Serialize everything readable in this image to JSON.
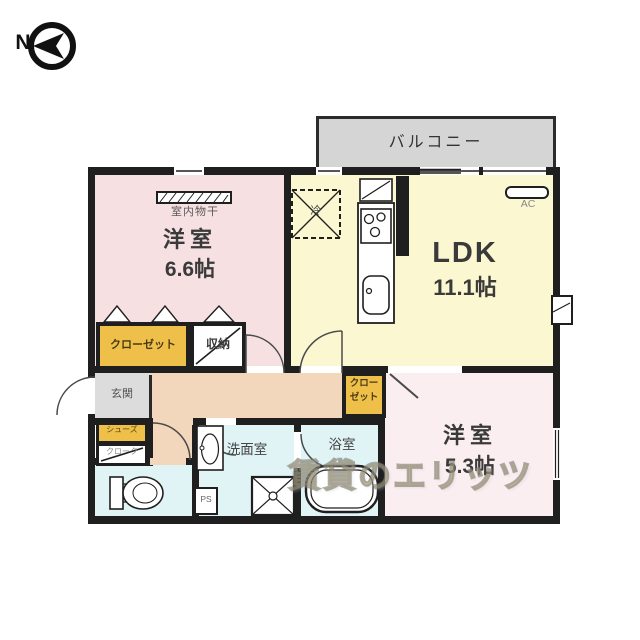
{
  "compass": {
    "north": "N"
  },
  "balcony": {
    "label": "バルコニー"
  },
  "bedroom1": {
    "name": "洋室",
    "size": "6.6帖",
    "drying": "室内物干"
  },
  "ldk": {
    "name": "LDK",
    "size": "11.1帖",
    "ac": "AC",
    "fridge": "冷"
  },
  "bedroom2": {
    "name": "洋室",
    "size": "5.3帖"
  },
  "closet1": {
    "label": "クローゼット"
  },
  "storage": {
    "label": "収納"
  },
  "closet2": {
    "line1": "クロー",
    "line2": "ゼット"
  },
  "entrance": {
    "label": "玄関"
  },
  "shoes_closet": {
    "line1": "シューズ",
    "line2": "クローク"
  },
  "washroom": {
    "label": "洗面室"
  },
  "bathroom": {
    "label": "浴室"
  },
  "pipe_space": {
    "label": "PS"
  },
  "watermark": {
    "text": "賃貸のエリッツ"
  },
  "colors": {
    "wall": "#1f1f1f",
    "bedroom1_fill": "#f7e0e1",
    "ldk_fill": "#fbf7d0",
    "bedroom2_fill": "#fbeef0",
    "hall_fill": "#f2d7bc",
    "wet_room_fill": "#e0f3f5",
    "closet_fill": "#efc049",
    "balcony_fill": "#d5d5d5",
    "entrance_fill": "#dcdcdc"
  }
}
